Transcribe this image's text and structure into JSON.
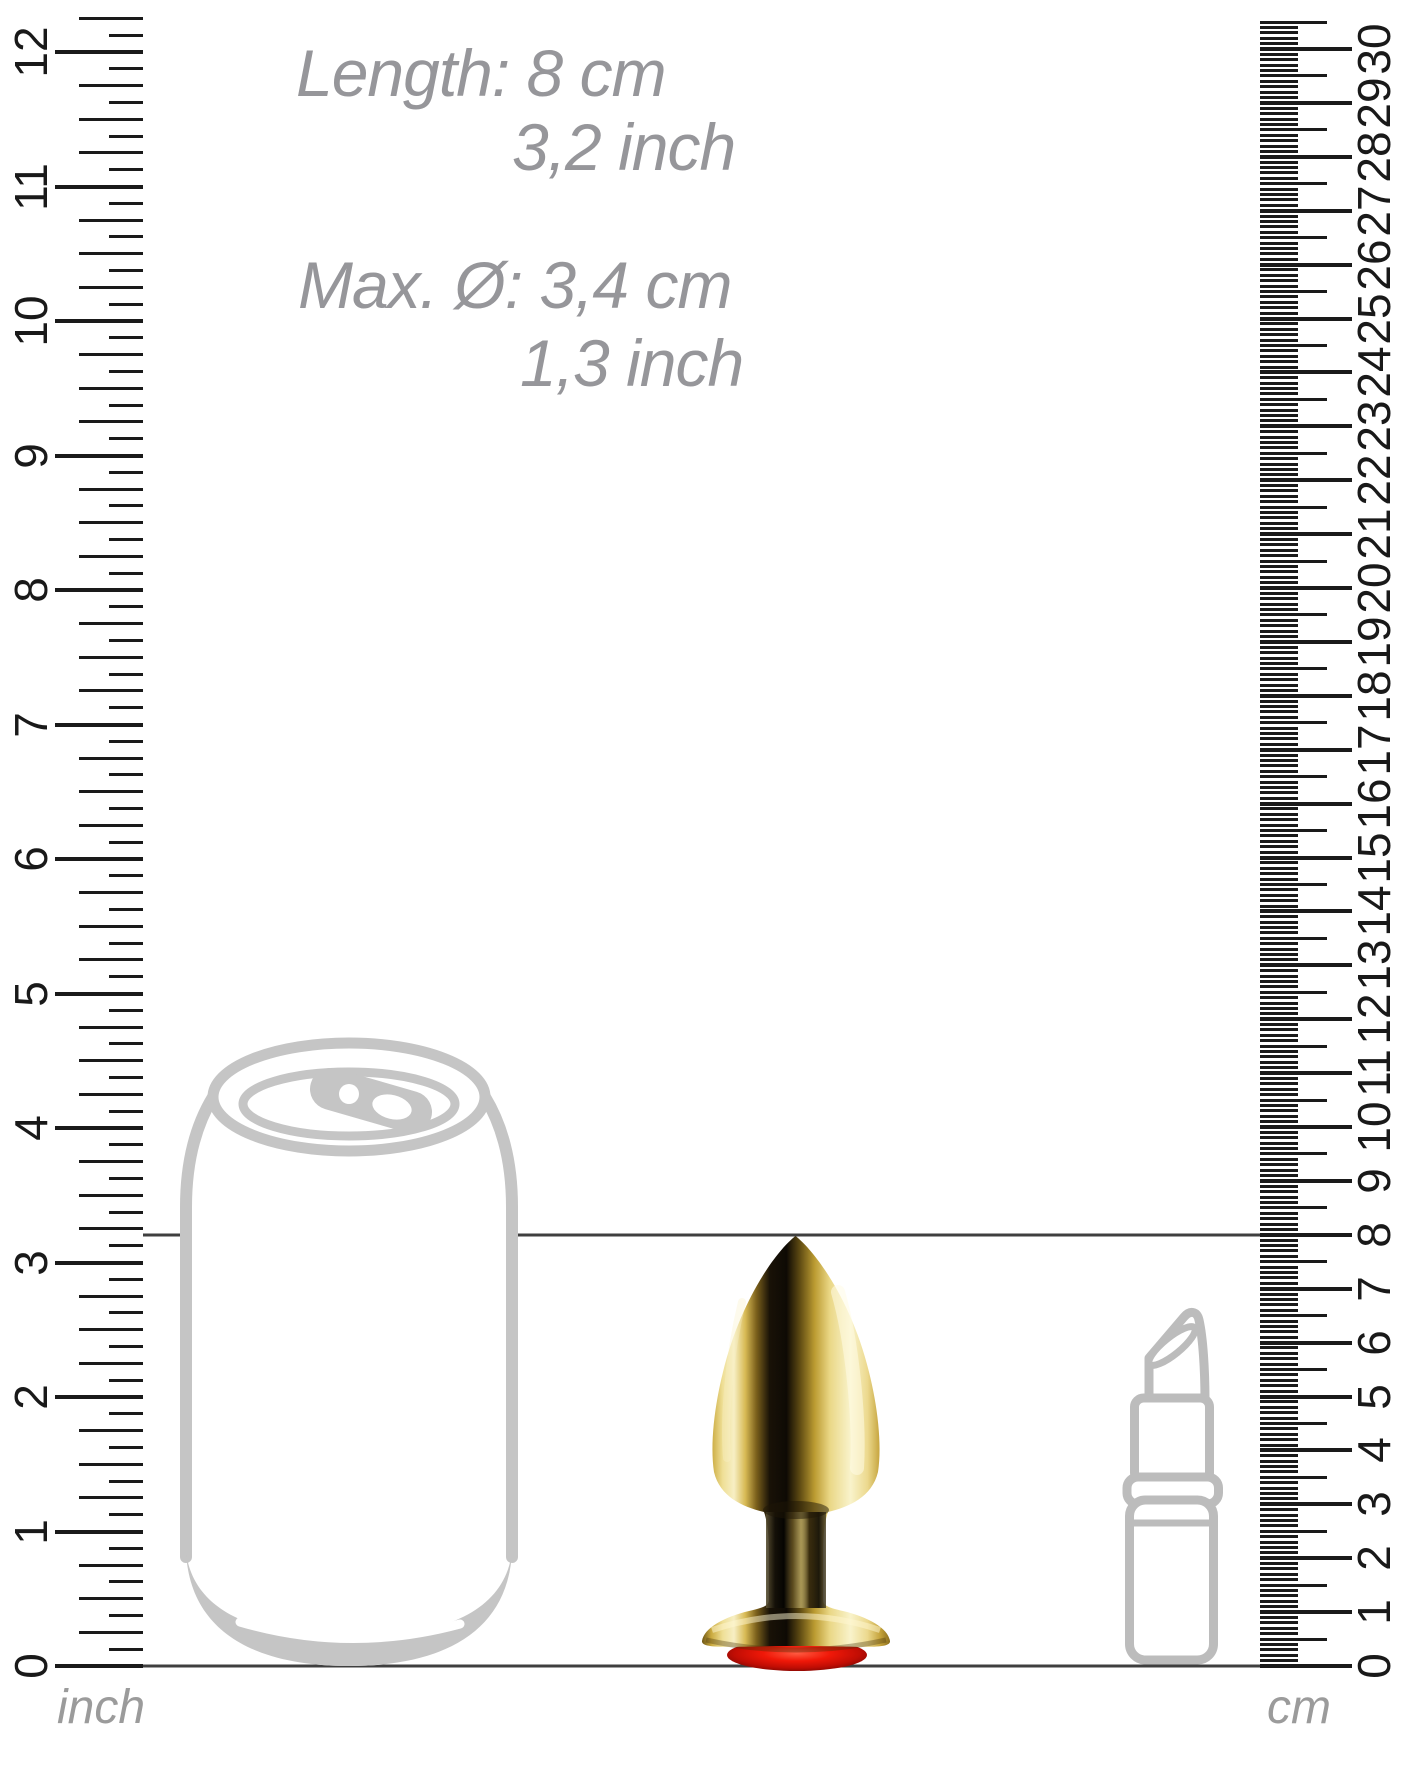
{
  "measurements": {
    "length_cm": "Length: 8 cm",
    "length_inch": "3,2 inch",
    "diameter_cm": "Max. Ø: 3,4 cm",
    "diameter_inch": "1,3 inch"
  },
  "markers": {
    "length_line_cm": 8
  },
  "rulers": {
    "inch": {
      "unit_label": "inch",
      "numbers": [
        "0",
        "1",
        "2",
        "3",
        "4",
        "5",
        "6",
        "7",
        "8",
        "9",
        "10",
        "11",
        "12"
      ]
    },
    "cm": {
      "unit_label": "cm",
      "numbers": [
        "0",
        "1",
        "2",
        "3",
        "4",
        "5",
        "6",
        "7",
        "8",
        "9",
        "10",
        "11",
        "12",
        "13",
        "14",
        "15",
        "16",
        "17",
        "18",
        "19",
        "20",
        "21",
        "22",
        "23",
        "24",
        "25",
        "26",
        "27",
        "28",
        "29",
        "30"
      ]
    }
  },
  "objects": {
    "can": "drink-can-outline",
    "lipstick": "lipstick-outline",
    "plug": "gold-plug-with-red-gem"
  },
  "colors": {
    "text_gray": "#96969a",
    "outline_gray": "#c5c5c5",
    "tick_black": "#1a1a1a",
    "marker_line": "#3f3f3f",
    "gold": "#e8d27d",
    "gem_red": "#e01408"
  }
}
